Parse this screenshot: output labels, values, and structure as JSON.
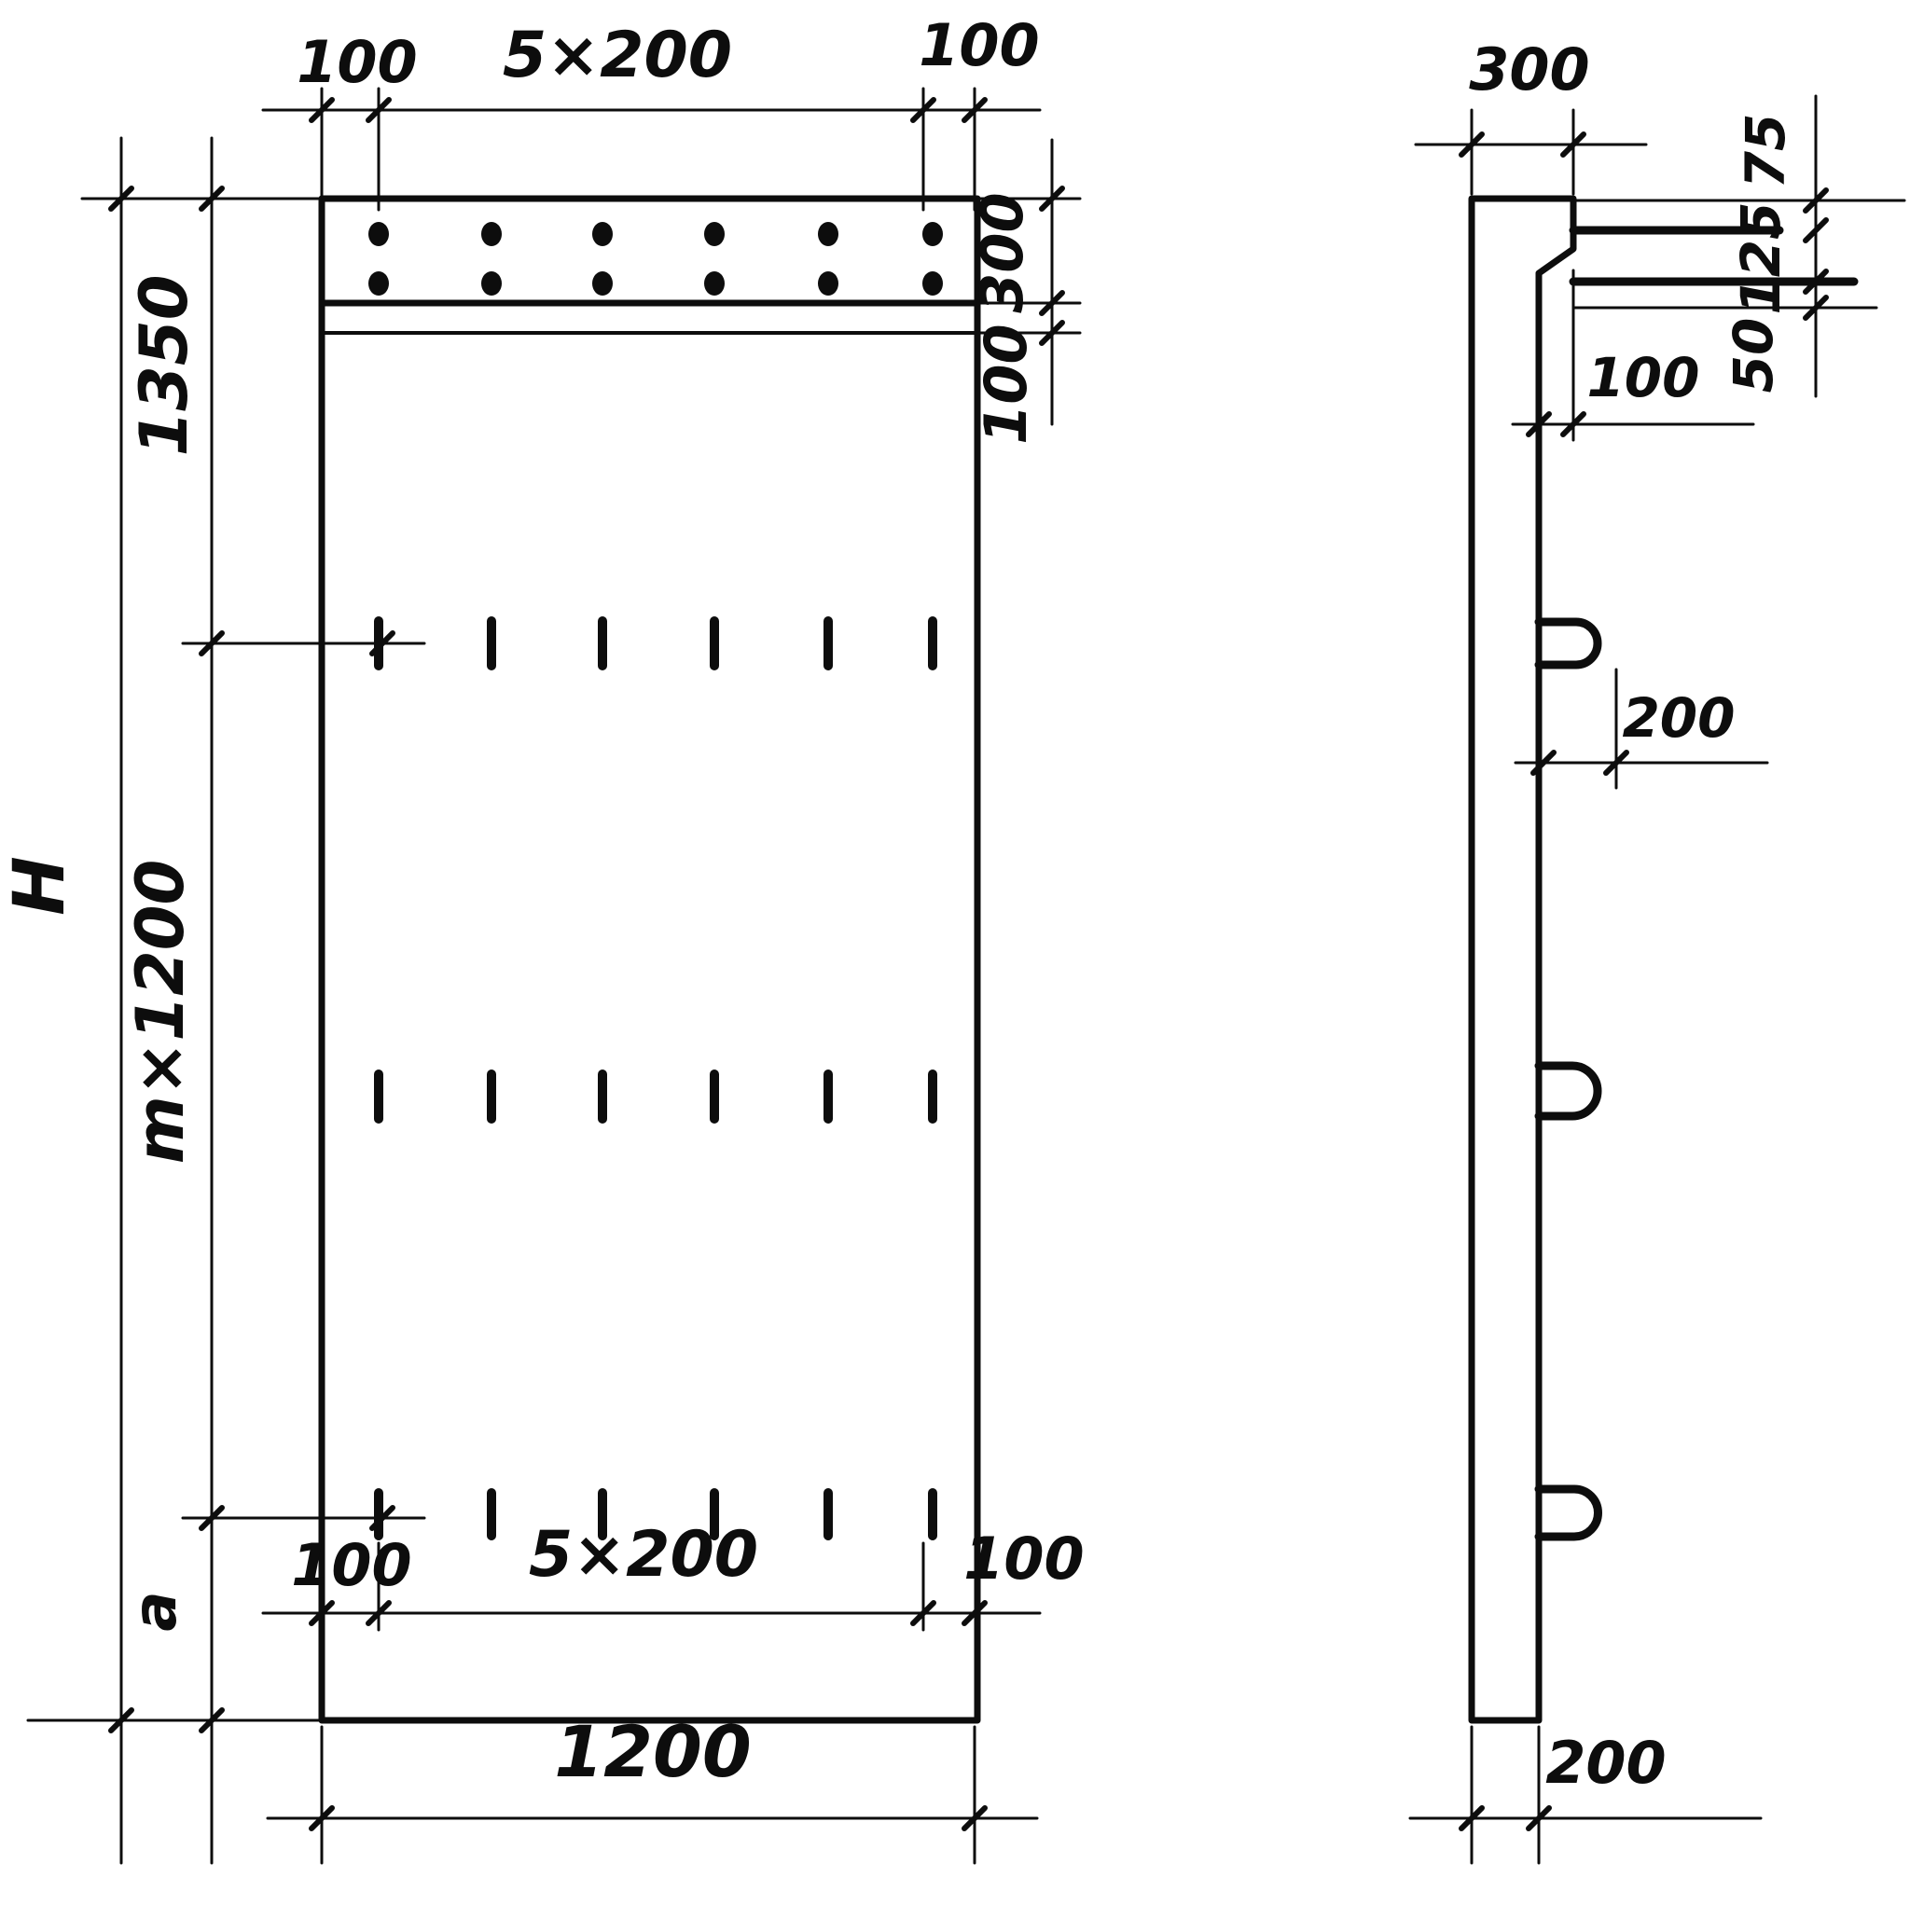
{
  "front_view": {
    "top_dims": {
      "left_margin": "100",
      "hole_spacing": "5×200",
      "right_margin": "100"
    },
    "right_dims": {
      "top_band_height": "300",
      "strip_height": "100"
    },
    "left_dims": {
      "top_section": "1350",
      "repeat_section": "m×1200",
      "bottom_section": "a",
      "total_height": "H"
    },
    "bottom_dims": {
      "left_margin": "100",
      "slot_spacing": "5×200",
      "right_margin": "100",
      "panel_width": "1200"
    }
  },
  "side_view": {
    "top_dims": {
      "top_thickness": "300"
    },
    "right_dims": {
      "top_offset": "75",
      "bar_spacing": "125",
      "bottom_offset": "50"
    },
    "ledge_dims": {
      "ledge_depth": "100"
    },
    "hook_dims": {
      "hook_projection": "200"
    },
    "bottom_dims": {
      "bottom_thickness": "200"
    }
  }
}
